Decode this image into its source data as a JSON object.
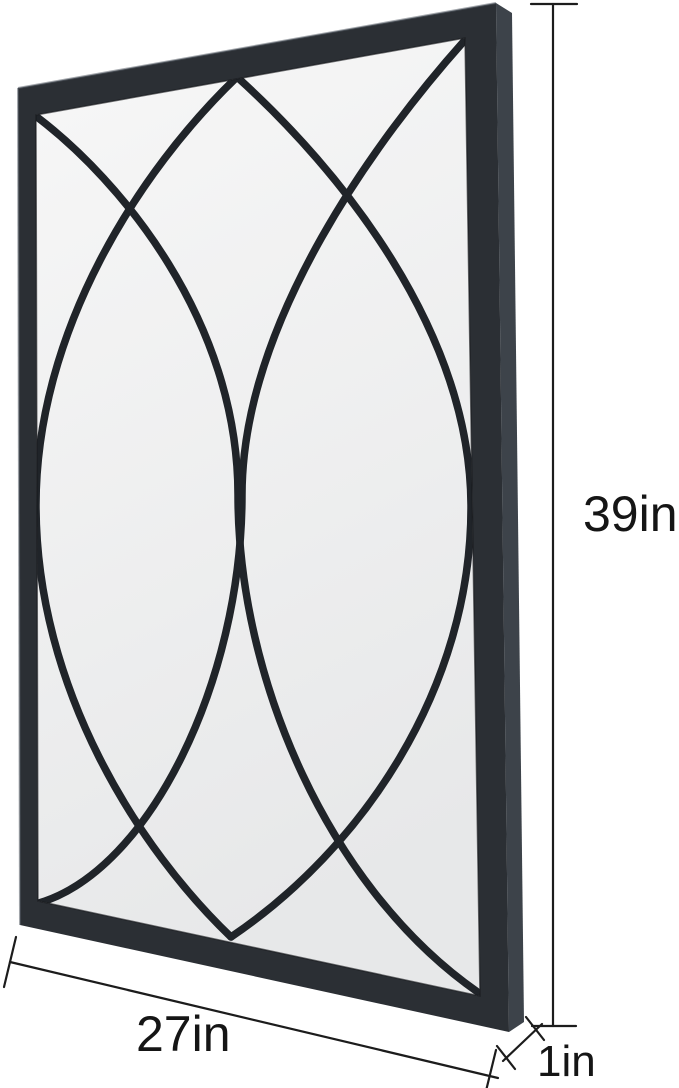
{
  "page": {
    "background": "#ffffff"
  },
  "mirror": {
    "frame_color": "#2b2f34",
    "frame_side_color": "#3d434a",
    "frame_highlight": "#5a616a",
    "frame_inner_shadow": "#16181b",
    "glass_top": "#f7f7f7",
    "glass_bottom": "#e7e8e9",
    "grille_color": "#202429"
  },
  "dimensions": {
    "height": {
      "label": "39in"
    },
    "width": {
      "label": "27in"
    },
    "depth": {
      "label": "1in"
    },
    "line_color": "#1c1c1c",
    "label_color": "#151515"
  }
}
